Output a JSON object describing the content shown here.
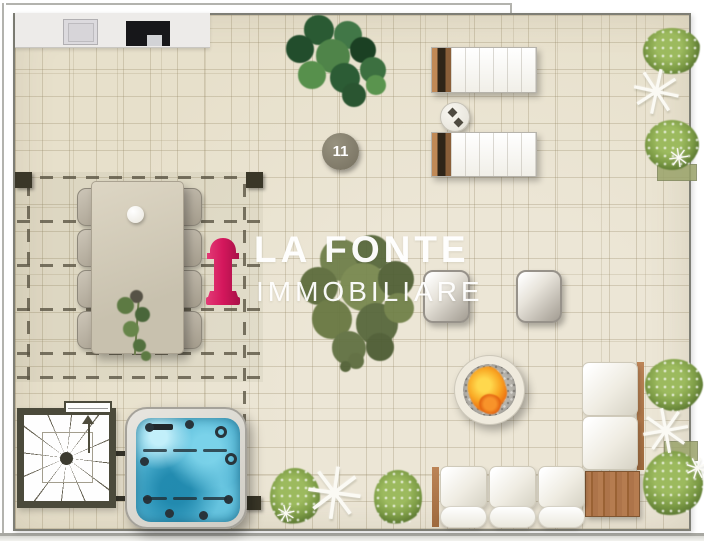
{
  "floor_plan": {
    "unit_badge": "11",
    "watermark": {
      "title": "LA FONTE",
      "subtitle": "IMMOBILIARE",
      "logo_color": "#d4175c"
    },
    "glyphs": {
      "palm_frond": "✳"
    },
    "palette": {
      "floor_beige": "#e7e0cb",
      "tile_line": "#a99a78",
      "water_blue": "#45b1d4",
      "fire_orange": "#f08a1d",
      "wood_brown": "#b07a52",
      "foliage_green": "#6f8f3f",
      "wall_grey": "#7e7e75"
    },
    "objects": [
      "outdoor-kitchen-counter",
      "sink",
      "grill",
      "monstera-plant",
      "unit-number-badge",
      "pergola",
      "dining-table",
      "dining-chairs",
      "table-plant",
      "logo-watermark",
      "center-tree",
      "sun-loungers",
      "lounger-side-table",
      "palm-plants",
      "armchairs",
      "fire-pit",
      "corner-sofa",
      "corner-wood-table",
      "hot-tub",
      "spiral-staircase"
    ]
  }
}
